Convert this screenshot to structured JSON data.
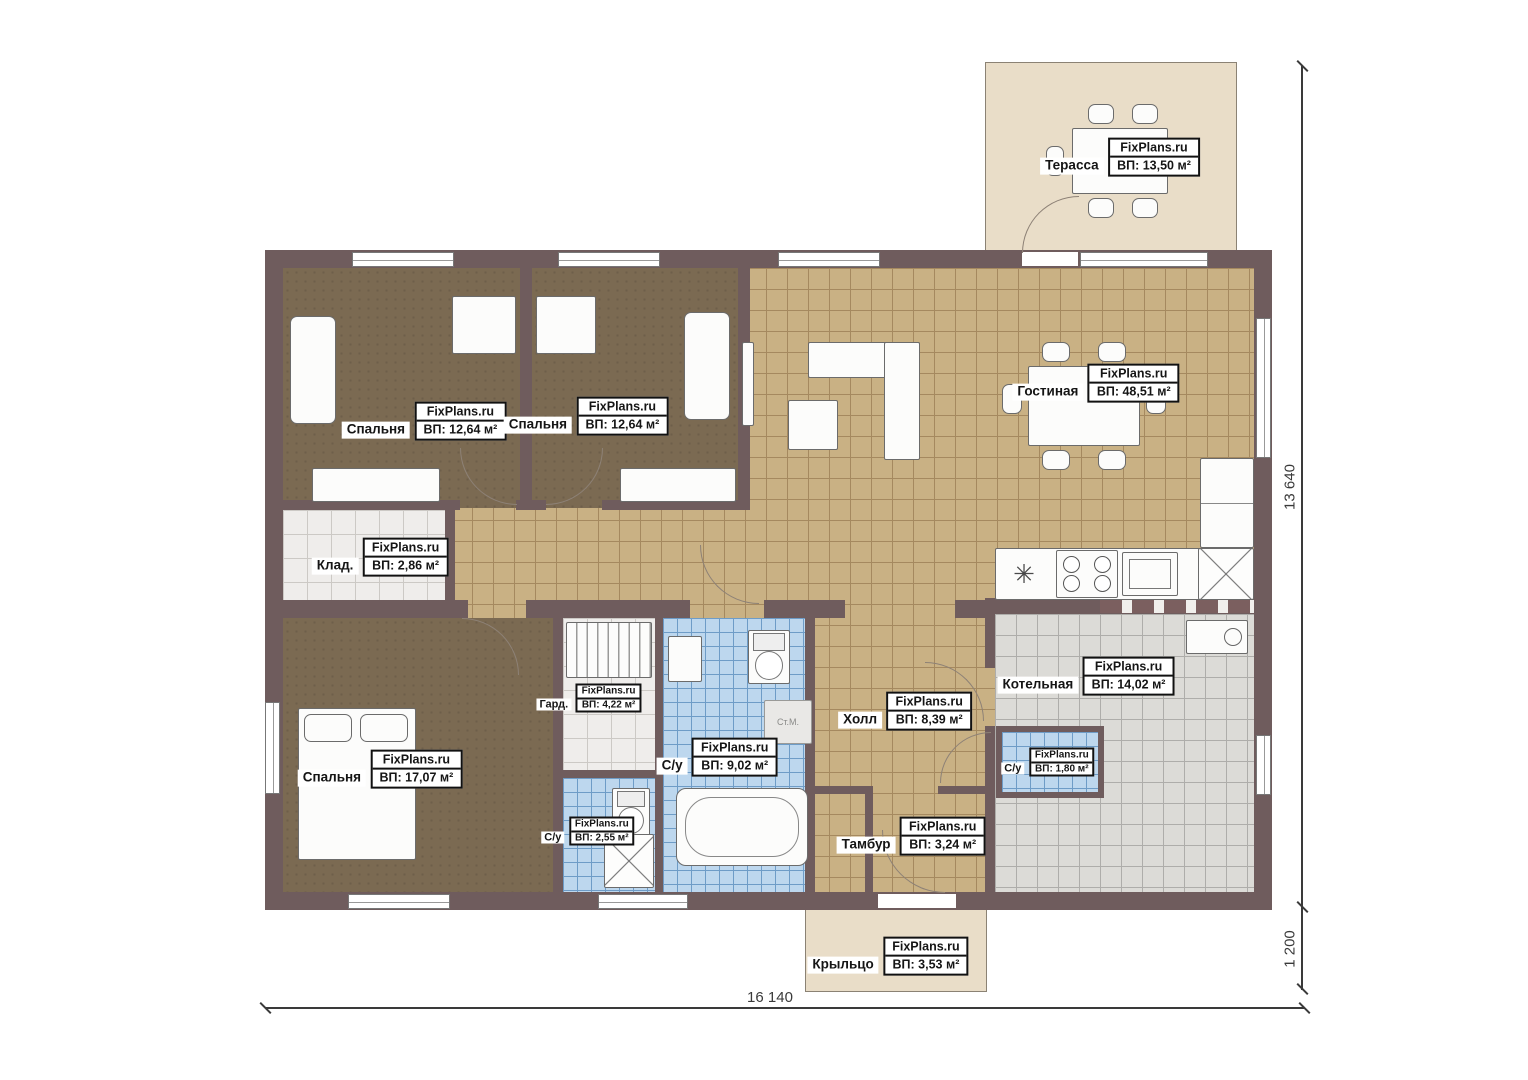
{
  "plan": {
    "brand": "FixPlans.ru",
    "rooms": [
      {
        "id": "terrace",
        "name": "Терасса",
        "area_label": "ВП: 13,50 м²"
      },
      {
        "id": "living-room",
        "name": "Гостиная",
        "area_label": "ВП: 48,51 м²"
      },
      {
        "id": "bedroom-1",
        "name": "Спальня",
        "area_label": "ВП: 12,64 м²"
      },
      {
        "id": "bedroom-2",
        "name": "Спальня",
        "area_label": "ВП: 12,64 м²"
      },
      {
        "id": "storage",
        "name": "Клад.",
        "area_label": "ВП: 2,86 м²"
      },
      {
        "id": "bedroom-3",
        "name": "Спальня",
        "area_label": "ВП: 17,07 м²"
      },
      {
        "id": "wardrobe",
        "name": "Гард.",
        "area_label": "ВП: 4,22 м²"
      },
      {
        "id": "bathroom-main",
        "name": "С/у",
        "area_label": "ВП: 9,02 м²"
      },
      {
        "id": "bathroom-small",
        "name": "С/у",
        "area_label": "ВП: 2,55 м²"
      },
      {
        "id": "hall",
        "name": "Холл",
        "area_label": "ВП: 8,39 м²"
      },
      {
        "id": "boiler-room",
        "name": "Котельная",
        "area_label": "ВП: 14,02 м²"
      },
      {
        "id": "bathroom-boiler",
        "name": "С/у",
        "area_label": "ВП: 1,80 м²"
      },
      {
        "id": "vestibule",
        "name": "Тамбур",
        "area_label": "ВП: 3,24 м²"
      },
      {
        "id": "porch",
        "name": "Крыльцо",
        "area_label": "ВП: 3,53 м²"
      }
    ],
    "annotations": {
      "washing_machine": "Ст.М."
    },
    "icons": {
      "kitchen_sink": "✳"
    },
    "dimensions": {
      "overall_width": "16 140",
      "overall_height": "13 640",
      "porch_depth": "1 200"
    },
    "colors": {
      "wall": "#6f5c5d",
      "floor_tile_tan": "#c9b184",
      "floor_wood_brown": "#7b6a52",
      "tile_blue": "#bdd7ee",
      "tile_gray": "#dcdbd7",
      "tile_light": "#efedeb",
      "outdoor_beige": "#e9ddc8"
    }
  }
}
